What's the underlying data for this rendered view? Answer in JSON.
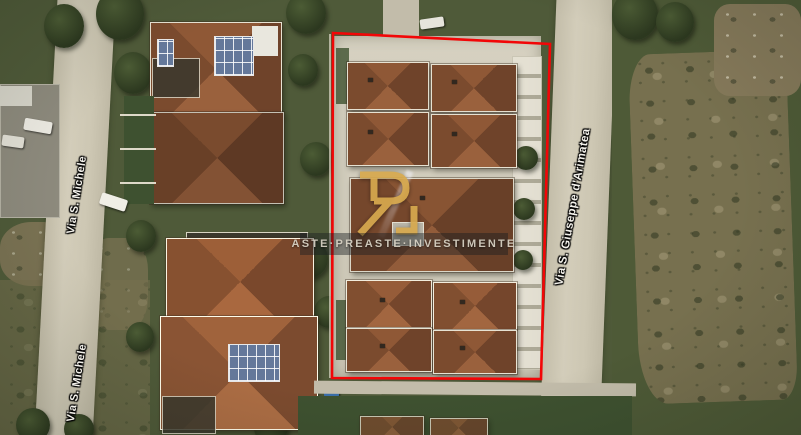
{
  "map": {
    "type": "satellite-photo",
    "street_labels": [
      {
        "id": "via-s-michele-upper",
        "text": "Via S. Michele"
      },
      {
        "id": "via-s-michele-lower",
        "text": "Via S. Michele"
      },
      {
        "id": "via-s-giuseppe-darimatea",
        "text": "Via S. Giuseppe d'Arimatea"
      }
    ],
    "boundary": {
      "color": "#f20607",
      "points": "333,33 550,44 541,379 332,378"
    },
    "watermark": {
      "monogram": "Ri",
      "text": "Aste·Preaste·Investimente",
      "gold_color": "#d7a94e"
    }
  }
}
